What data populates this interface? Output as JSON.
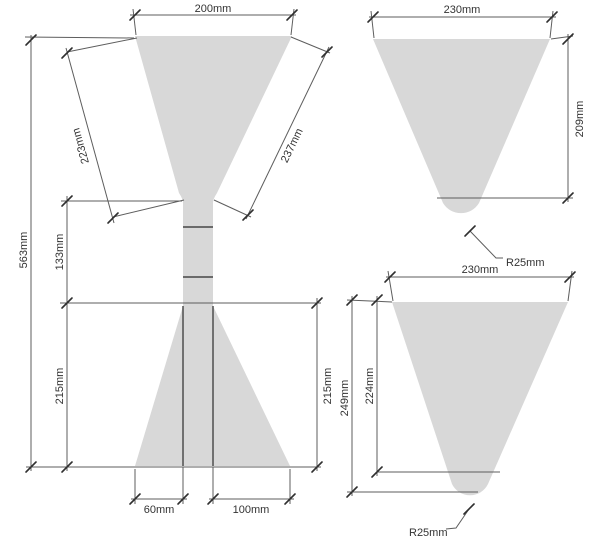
{
  "meta": {
    "title": "Funnel technical dimension drawing",
    "views": [
      "hourglass front view",
      "cone view short",
      "cone view deep"
    ]
  },
  "colors": {
    "background": "#ffffff",
    "shape_fill": "#d8d8d8",
    "outline": "#454545",
    "dim_line": "#5d5d5d",
    "text": "#333333"
  },
  "figures": {
    "left": {
      "name": "hourglass funnel front view",
      "labels": {
        "top_width": "200mm",
        "left_slant": "223mm",
        "right_slant": "237mm",
        "total_height": "563mm",
        "neck_height": "133mm",
        "lower_left_height": "215mm",
        "lower_right_height": "215mm",
        "bottom_left_width": "60mm",
        "bottom_right_width": "100mm"
      }
    },
    "top_right": {
      "name": "cone funnel view short",
      "labels": {
        "top_width": "230mm",
        "height": "209mm",
        "tip_radius": "R25mm"
      }
    },
    "bottom_right": {
      "name": "cone funnel view deep",
      "labels": {
        "top_width": "230mm",
        "outer_height": "249mm",
        "inner_height": "224mm",
        "tip_radius": "R25mm"
      }
    }
  }
}
